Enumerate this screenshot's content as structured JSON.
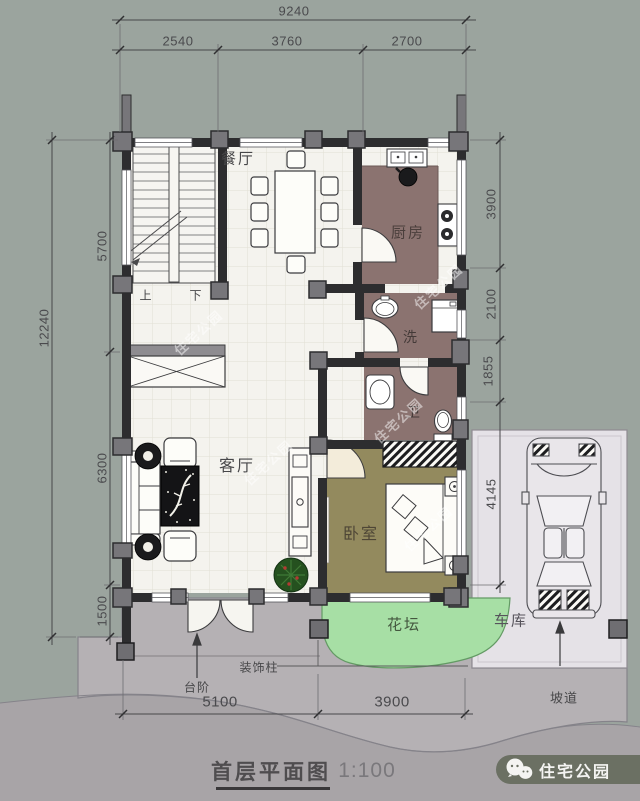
{
  "drawing": {
    "title": "首层平面图",
    "scale": "1:100"
  },
  "logo": {
    "name": "住宅公园",
    "icon": "wechat-icon"
  },
  "watermark": {
    "text": "住宅公园"
  },
  "dimensions": {
    "top": {
      "total": "9240",
      "segments": [
        "2540",
        "3760",
        "2700"
      ]
    },
    "left": {
      "total": "12240",
      "segments": [
        "5700",
        "6300",
        "1500"
      ]
    },
    "right": {
      "segments": [
        "3900",
        "2100",
        "1855",
        "4145"
      ]
    },
    "bottom": {
      "segments": [
        "5100",
        "3900"
      ]
    }
  },
  "rooms": {
    "dining": "餐厅",
    "kitchen": "厨房",
    "laundry": "洗",
    "bath": "卫",
    "living": "客厅",
    "bedroom": "卧室",
    "flowerbed": "花坛",
    "garage": "车库"
  },
  "stairs": {
    "up": "上",
    "down": "下"
  },
  "annotations": {
    "decorative_column": "装饰柱",
    "steps": "台阶",
    "ramp": "坡道"
  },
  "colors": {
    "background_top": "#9ba49e",
    "background_bottom": "#a8a4a7",
    "terrace": "#b5b1b4",
    "garage_pad": "#e5e2e7",
    "flowerbed": "#a7dfa5",
    "tile_floor": "#f4f3ee",
    "kitchen_bath_floor": "#8b7370",
    "bedroom_floor": "#938a5e",
    "walls": "#2d2d2f",
    "logo_band": "#6b7063"
  }
}
